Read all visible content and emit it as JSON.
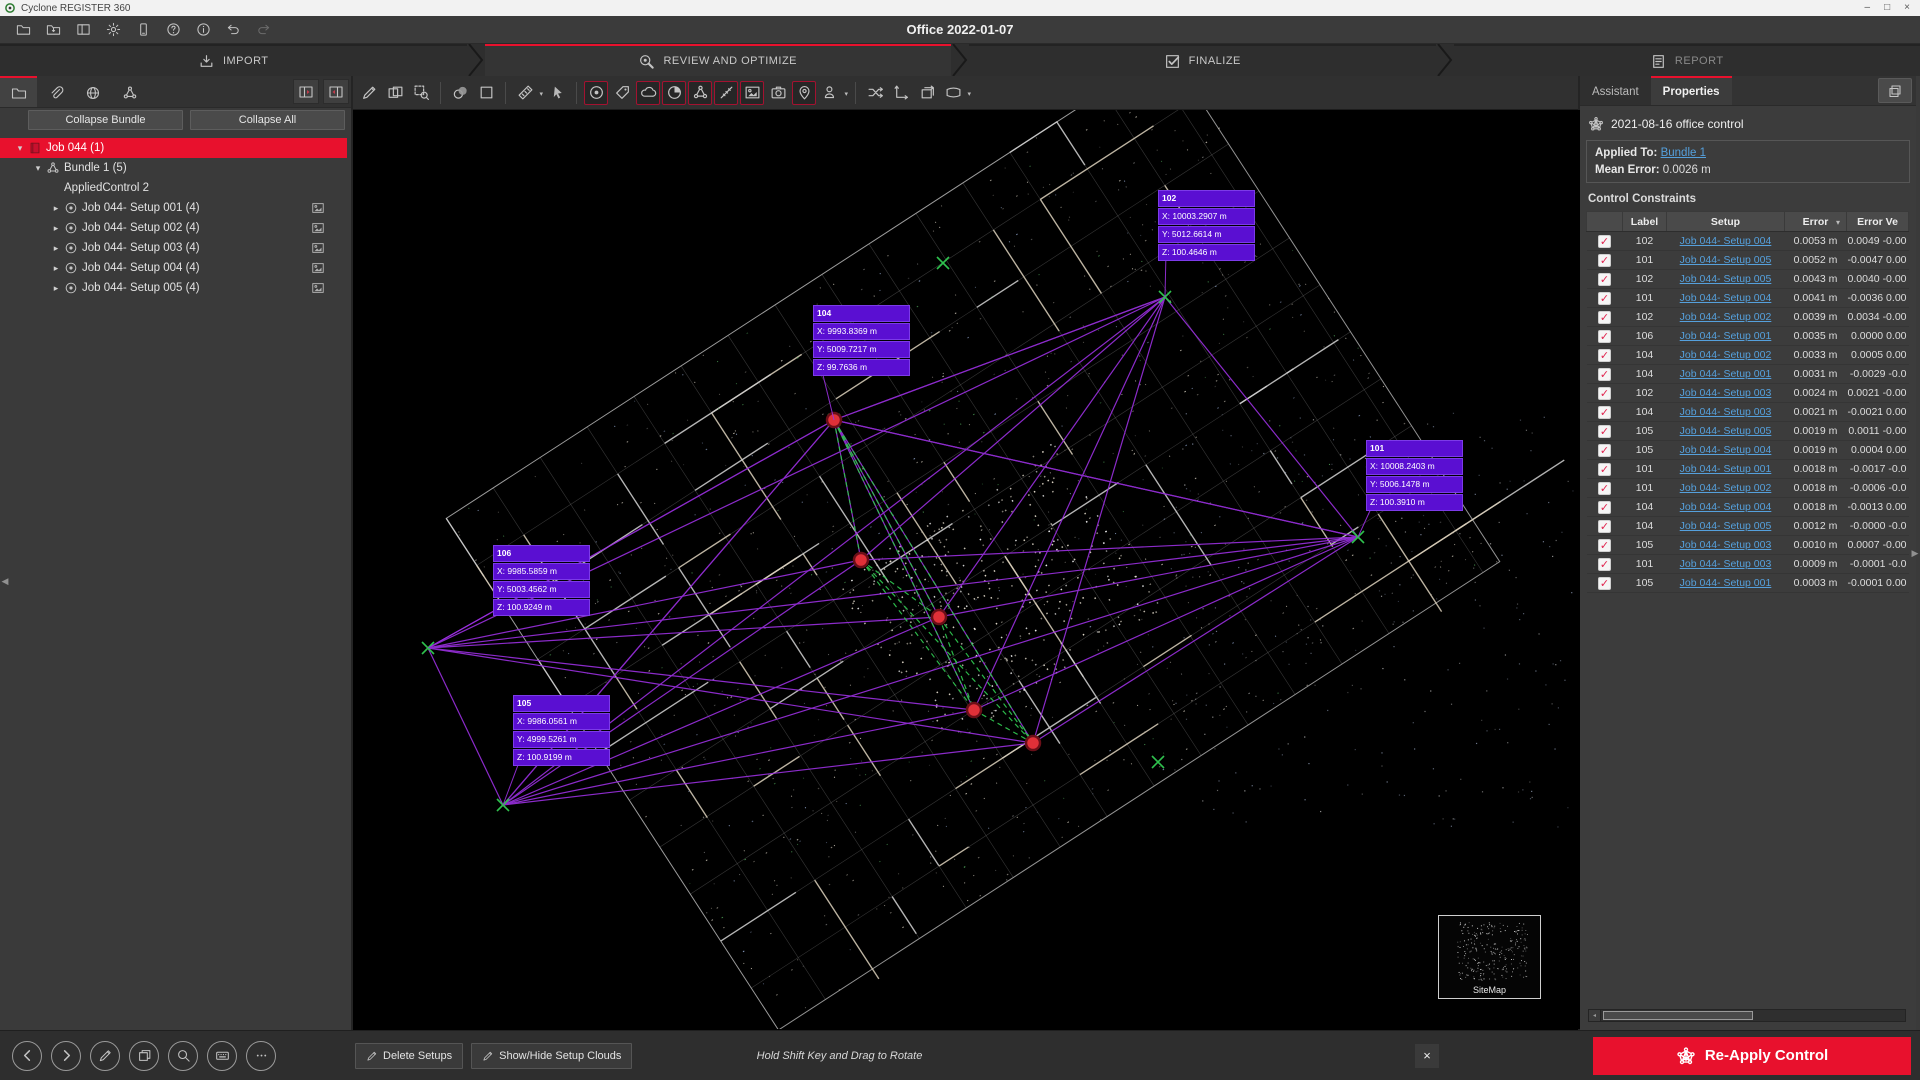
{
  "window": {
    "app_title": "Cyclone REGISTER 360",
    "doc_title": "Office 2022-01-07",
    "controls": {
      "minimize": "–",
      "maximize": "□",
      "close": "×"
    }
  },
  "menubar": {
    "icons": [
      {
        "name": "open-project-icon",
        "glyph": "folder"
      },
      {
        "name": "import-project-icon",
        "glyph": "folder-import"
      },
      {
        "name": "panels-icon",
        "glyph": "panels"
      },
      {
        "name": "settings-gear-icon",
        "glyph": "gear"
      },
      {
        "name": "storage-icon",
        "glyph": "device"
      },
      {
        "name": "help-icon",
        "glyph": "help"
      },
      {
        "name": "info-icon",
        "glyph": "info"
      },
      {
        "name": "undo-icon",
        "glyph": "undo"
      },
      {
        "name": "redo-icon",
        "glyph": "redo",
        "disabled": true
      }
    ]
  },
  "workflow": {
    "tabs": [
      {
        "label": "IMPORT",
        "icon": "import-icon",
        "glyph": "import",
        "active": false
      },
      {
        "label": "REVIEW AND OPTIMIZE",
        "icon": "review-icon",
        "glyph": "review",
        "active": true
      },
      {
        "label": "FINALIZE",
        "icon": "finalize-icon",
        "glyph": "finalize",
        "active": false
      },
      {
        "label": "REPORT",
        "icon": "report-icon",
        "glyph": "report",
        "active": false,
        "dim": true
      }
    ]
  },
  "sidebar": {
    "tabs": [
      {
        "name": "project-explorer-tab",
        "glyph": "folder",
        "active": true
      },
      {
        "name": "links-tab",
        "glyph": "paperclip",
        "active": false
      },
      {
        "name": "geo-tab",
        "glyph": "globe",
        "active": false
      },
      {
        "name": "bundle-tab",
        "glyph": "bundle",
        "active": false
      }
    ],
    "header_buttons": [
      {
        "name": "expand-all-icon",
        "glyph": "expand-all"
      },
      {
        "name": "collapse-all-icon",
        "glyph": "collapse-all"
      }
    ],
    "collapse_bundle_label": "Collapse Bundle",
    "collapse_all_label": "Collapse All",
    "tree": [
      {
        "label": "Job 044 (1)",
        "glyph": "book",
        "depth": 0,
        "caret": "down",
        "selected": true
      },
      {
        "label": "Bundle 1 (5)",
        "glyph": "bundle",
        "depth": 1,
        "caret": "down"
      },
      {
        "label": "AppliedControl 2",
        "glyph": null,
        "depth": 2,
        "caret": null
      },
      {
        "label": "Job 044- Setup 001 (4)",
        "glyph": "setups",
        "depth": 2,
        "caret": "right",
        "pano": true
      },
      {
        "label": "Job 044- Setup 002 (4)",
        "glyph": "setups",
        "depth": 2,
        "caret": "right",
        "pano": true
      },
      {
        "label": "Job 044- Setup 003 (4)",
        "glyph": "setups",
        "depth": 2,
        "caret": "right",
        "pano": true
      },
      {
        "label": "Job 044- Setup 004 (4)",
        "glyph": "setups",
        "depth": 2,
        "caret": "right",
        "pano": true
      },
      {
        "label": "Job 044- Setup 005 (4)",
        "glyph": "setups",
        "depth": 2,
        "caret": "right",
        "pano": true
      }
    ],
    "nav_buttons": [
      {
        "name": "back-icon",
        "glyph": "back"
      },
      {
        "name": "forward-icon",
        "glyph": "forward"
      },
      {
        "name": "edit-icon",
        "glyph": "pencil"
      },
      {
        "name": "copy-icon",
        "glyph": "copy"
      },
      {
        "name": "search-icon",
        "glyph": "search"
      },
      {
        "name": "keyboard-icon",
        "glyph": "keyboard"
      },
      {
        "name": "more-icon",
        "glyph": "more"
      }
    ]
  },
  "viewport": {
    "toolbar_groups": [
      {
        "icons": [
          {
            "name": "adjust-icon",
            "glyph": "pencil"
          },
          {
            "name": "split-view-icon",
            "glyph": "split"
          },
          {
            "name": "zoom-region-icon",
            "glyph": "zoom-region"
          }
        ]
      },
      {
        "icons": [
          {
            "name": "cloud-overlap-icon",
            "glyph": "overlap"
          },
          {
            "name": "square-select-icon",
            "glyph": "square"
          }
        ]
      },
      {
        "icons": [
          {
            "name": "measure-icon",
            "glyph": "measure",
            "caret": true
          },
          {
            "name": "select-cursor-icon",
            "glyph": "cursor"
          }
        ]
      },
      {
        "icons": [
          {
            "name": "setups-toggle-icon",
            "glyph": "setups",
            "active": true
          },
          {
            "name": "tags-toggle-icon",
            "glyph": "tag"
          },
          {
            "name": "clouds-toggle-icon",
            "glyph": "cloud",
            "active": true
          },
          {
            "name": "quality-toggle-icon",
            "glyph": "quality",
            "active": true
          },
          {
            "name": "bundle-toggle-icon",
            "glyph": "bundle",
            "active": true
          },
          {
            "name": "links-toggle-icon",
            "glyph": "wand",
            "active": true
          },
          {
            "name": "images-toggle-icon",
            "glyph": "image",
            "active": true
          },
          {
            "name": "camera-icon",
            "glyph": "camera"
          },
          {
            "name": "geotags-toggle-icon",
            "glyph": "pin",
            "active": true
          },
          {
            "name": "people-icon",
            "glyph": "person",
            "caret": true
          }
        ]
      },
      {
        "icons": [
          {
            "name": "shuffle-links-icon",
            "glyph": "shuffle"
          },
          {
            "name": "axes-icon",
            "glyph": "axes"
          },
          {
            "name": "rotate-image-icon",
            "glyph": "rotate-image"
          },
          {
            "name": "pano-icon",
            "glyph": "pano",
            "caret": true
          }
        ]
      }
    ],
    "stations": [
      {
        "id": "102",
        "x": "X: 10003.2907 m",
        "y": "Y: 5012.6614 m",
        "z": "Z: 100.4646 m",
        "pos": [
          805,
          80
        ],
        "marker": [
          812,
          187
        ]
      },
      {
        "id": "104",
        "x": "X: 9993.8369 m",
        "y": "Y: 5009.7217 m",
        "z": "Z: 99.7636 m",
        "pos": [
          460,
          195
        ],
        "marker": [
          481,
          310
        ]
      },
      {
        "id": "101",
        "x": "X: 10008.2403 m",
        "y": "Y: 5006.1478 m",
        "z": "Z: 100.3910 m",
        "pos": [
          1013,
          330
        ],
        "marker": [
          1005,
          427
        ]
      },
      {
        "id": "106",
        "x": "X: 9985.5859 m",
        "y": "Y: 5003.4562 m",
        "z": "Z: 100.9249 m",
        "pos": [
          140,
          435
        ],
        "marker": [
          75,
          538
        ]
      },
      {
        "id": "105",
        "x": "X: 9986.0561 m",
        "y": "Y: 4999.5261 m",
        "z": "Z: 100.9199 m",
        "pos": [
          160,
          585
        ],
        "marker": [
          150,
          695
        ]
      }
    ],
    "setup_points": [
      [
        481,
        310
      ],
      [
        508,
        450
      ],
      [
        586,
        507
      ],
      [
        621,
        600
      ],
      [
        680,
        633
      ]
    ],
    "extra_markers": [
      [
        590,
        153
      ],
      [
        805,
        652
      ]
    ],
    "sitemap_label": "SiteMap"
  },
  "properties_panel": {
    "tabs": [
      {
        "label": "Assistant",
        "active": false
      },
      {
        "label": "Properties",
        "active": true
      }
    ],
    "control_name": "2021-08-16 office control",
    "applied_to_label": "Applied To:",
    "applied_to_value": "Bundle 1",
    "mean_error_label": "Mean Error:",
    "mean_error_value": "0.0026 m",
    "section_title": "Control Constraints",
    "table": {
      "columns": [
        "",
        "Label",
        "Setup",
        "Error",
        "Error Ve"
      ],
      "rows": [
        [
          true,
          "102",
          "Job 044- Setup 004",
          "0.0053 m",
          "0.0049 -0.00"
        ],
        [
          true,
          "101",
          "Job 044- Setup 005",
          "0.0052 m",
          "-0.0047 0.00"
        ],
        [
          true,
          "102",
          "Job 044- Setup 005",
          "0.0043 m",
          "0.0040 -0.00"
        ],
        [
          true,
          "101",
          "Job 044- Setup 004",
          "0.0041 m",
          "-0.0036 0.00"
        ],
        [
          true,
          "102",
          "Job 044- Setup 002",
          "0.0039 m",
          "0.0034 -0.00"
        ],
        [
          true,
          "106",
          "Job 044- Setup 001",
          "0.0035 m",
          "0.0000 0.00"
        ],
        [
          true,
          "104",
          "Job 044- Setup 002",
          "0.0033 m",
          "0.0005 0.00"
        ],
        [
          true,
          "104",
          "Job 044- Setup 001",
          "0.0031 m",
          "-0.0029 -0.0"
        ],
        [
          true,
          "102",
          "Job 044- Setup 003",
          "0.0024 m",
          "0.0021 -0.00"
        ],
        [
          true,
          "104",
          "Job 044- Setup 003",
          "0.0021 m",
          "-0.0021 0.00"
        ],
        [
          true,
          "105",
          "Job 044- Setup 005",
          "0.0019 m",
          "0.0011 -0.00"
        ],
        [
          true,
          "105",
          "Job 044- Setup 004",
          "0.0019 m",
          "0.0004 0.00"
        ],
        [
          true,
          "101",
          "Job 044- Setup 001",
          "0.0018 m",
          "-0.0017 -0.0"
        ],
        [
          true,
          "101",
          "Job 044- Setup 002",
          "0.0018 m",
          "-0.0006 -0.0"
        ],
        [
          true,
          "104",
          "Job 044- Setup 004",
          "0.0018 m",
          "-0.0013 0.00"
        ],
        [
          true,
          "104",
          "Job 044- Setup 005",
          "0.0012 m",
          "-0.0000 -0.0"
        ],
        [
          true,
          "105",
          "Job 044- Setup 003",
          "0.0010 m",
          "0.0007 -0.00"
        ],
        [
          true,
          "101",
          "Job 044- Setup 003",
          "0.0009 m",
          "-0.0001 -0.0"
        ],
        [
          true,
          "105",
          "Job 044- Setup 001",
          "0.0003 m",
          "-0.0001 0.00"
        ]
      ]
    }
  },
  "bottombar": {
    "delete_setups_label": "Delete Setups",
    "show_hide_label": "Show/Hide Setup Clouds",
    "hint": "Hold Shift Key and Drag to Rotate",
    "close_label": "×",
    "reapply_label": "Re-Apply Control"
  },
  "colors": {
    "accent_red": "#e8112d",
    "purple_link": "#9b30e0",
    "label_bg": "#5a0fd2",
    "table_link_blue": "#55a0dc",
    "green_marker": "#2fc24e",
    "setup_dot_red": "#e03038"
  }
}
